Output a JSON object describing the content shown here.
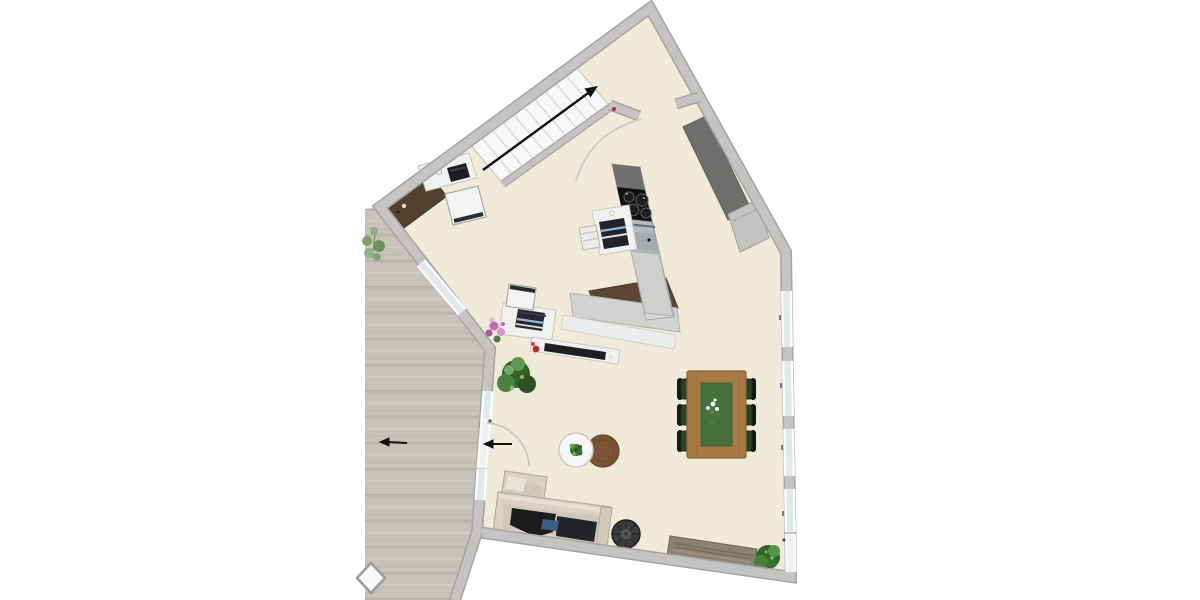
{
  "meta": {
    "type": "floor-plan-render",
    "description": "Top-down 2D render of an open-plan ground floor with staircase, kitchen, dining and lounge areas plus an adjoining wooden deck terrace",
    "visible_text": "none"
  },
  "palette": {
    "background": "#ffffff",
    "floor": "#f0ead9",
    "wall_fill": "#c6c4c2",
    "wall_edge": "#a6a4a2",
    "deck": "#c8c3ba",
    "glazing": "#dfeaec",
    "stair_tread": "#f8f8f8",
    "wood_table": "#a87945",
    "table_runner": "#47703c",
    "counter_dark": "#6e6e6c",
    "appliance_steel": "#b7bcbe",
    "cooktop_black": "#101010",
    "sofa_beige": "#d9d2c3",
    "sofa_throw": "#1b1b1d",
    "kitchen_mat_brown": "#5a4632",
    "sideboard_brown": "#53402d",
    "plant_green": "#4a8a3f",
    "flower_pink": "#c06cb0",
    "side_table_brown": "#7b5334",
    "pouf_gray": "#3b3b3e",
    "bench_stone": "#8d8271",
    "arrow_black": "#111111"
  },
  "rooms": {
    "main": {
      "label": "open plan living area with kitchen, dining and lounge"
    },
    "terrace": {
      "label": "wooden deck terrace"
    }
  },
  "items": {
    "stairs": {
      "label": "staircase with direction-up arrow",
      "steps": 10
    },
    "stair_arrow": {
      "label": "stair direction arrow pointing up-right"
    },
    "stair_rail": {
      "label": "stair side wall"
    },
    "desk_corner": {
      "label": "corner desk with laptop and mug"
    },
    "office_chair_1": {
      "label": "office chair at corner desk"
    },
    "sideboard_dark": {
      "label": "dark wood sideboard along wall"
    },
    "kitchen_column": {
      "label": "kitchen counter run with cooktop and oven"
    },
    "cooktop": {
      "label": "four-burner black cooktop",
      "burners": 4
    },
    "oven": {
      "label": "stainless steel oven"
    },
    "kitchen_counter_low": {
      "label": "lower kitchen counter return"
    },
    "kitchen_mat": {
      "label": "brown kitchen runner mat"
    },
    "coffee_cart": {
      "label": "white cart with coffee machine"
    },
    "stool": {
      "label": "white stool beside cart"
    },
    "wall_counter": {
      "label": "tall dark cabinet along upper-right wall"
    },
    "appliance_box": {
      "label": "light appliance cabinet at counter end"
    },
    "desk_2": {
      "label": "desk with printer"
    },
    "office_chair_2": {
      "label": "office chair at printer desk"
    },
    "flower_pot": {
      "label": "pink flowering plant"
    },
    "lowboard": {
      "label": "white lowboard with hi-fi soundbar and red bottles"
    },
    "plant_large": {
      "label": "large indoor potted plant"
    },
    "dining_table": {
      "label": "wooden dining table with green runner and flowers"
    },
    "dining_chairs": {
      "label": "dark green dining chairs",
      "count": 6
    },
    "coffee_table": {
      "label": "round white coffee table with small plant"
    },
    "side_table_brown": {
      "label": "round brown side table"
    },
    "sofa": {
      "label": "beige corner sofa with dark throw and blue pillow"
    },
    "pouf": {
      "label": "round ribbed pouf"
    },
    "bench": {
      "label": "stone bench along bottom wall"
    },
    "plant_corner": {
      "label": "potted plant in bottom-right corner"
    },
    "plant_terrace": {
      "label": "sparse plant on terrace"
    },
    "terrace_door": {
      "label": "terrace door with swing arc and exit arrows"
    },
    "terrace_window": {
      "label": "window in terrace-side wall"
    },
    "windows_right": {
      "label": "window band in right wall",
      "count": 4
    },
    "right_door": {
      "label": "glazed door at bottom of right wall"
    },
    "deck_tile": {
      "label": "stepping tile on deck edge"
    },
    "passage": {
      "label": "doorway opening between stair hall and kitchen"
    }
  }
}
